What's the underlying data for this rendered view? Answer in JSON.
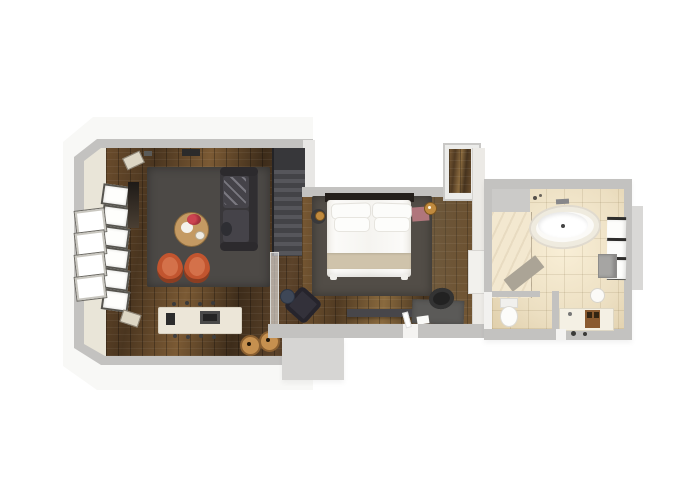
{
  "scene": {
    "type": "floor-plan-3d-render",
    "view": "top-down",
    "description": "3D rendered floor plan of a one-bedroom suite: open living room with staircase, bedroom, corridor closet and bathroom",
    "visible_text": ""
  },
  "colors": {
    "background": "#ffffff",
    "shell_white": "#f8f8f6",
    "wall_gray": "#c3c2c0",
    "inner_face": "#e9e5d8",
    "wood_living": "#4e3a24",
    "wood_bedroom": "#5d452b",
    "rug_living": "#4c4946",
    "rug_bedroom": "#524d47",
    "sofa_dark": "#39373a",
    "sofa_cushion": "#454349",
    "chair_orange": "#c2552f",
    "chair_orange_light": "#d4714a",
    "coffee_table": "#c49a63",
    "media_console": "#ece6d8",
    "stool_wood": "#c6904f",
    "stairs_dark": "#434347",
    "bed_linen": "#f6f5f2",
    "bed_runner": "#cfc3ab",
    "headboard": "#241f1b",
    "bench_mauve": "#b0767c",
    "lamp_brass": "#c08a3e",
    "desk_gray": "#5b5a58",
    "chair_black": "#222222",
    "landing_gray": "#d6d5d3",
    "tile_beige": "#ecdfc2",
    "tile_glow": "#f9efd7",
    "tub_white": "#fbfaf7",
    "shower_mat": "#aba496",
    "cabinet_gray": "#a6a5a3",
    "towel_white": "#fdfdfb",
    "towel_rail": "#2f2e2c",
    "wall_protrusion": "#d9d8d6"
  },
  "rooms": [
    {
      "id": "living-room",
      "furniture": [
        "area rug",
        "sectional sofa with throw",
        "round coffee table with flowers",
        "two orange lounge chairs",
        "media console",
        "two wooden stools",
        "panoramic window wall",
        "wall art",
        "wall speakers"
      ]
    },
    {
      "id": "staircase",
      "furniture": [
        "stairs with glass balustrade"
      ]
    },
    {
      "id": "bedroom",
      "furniture": [
        "double bed with four pillows",
        "bed runner",
        "area rug",
        "round nightstand with brass lamp",
        "mauve bench with brass lamp",
        "dark armchair",
        "round side table",
        "low media bench",
        "desk with chair and papers"
      ]
    },
    {
      "id": "corridor",
      "furniture": [
        "closet nook",
        "wardrobe"
      ]
    },
    {
      "id": "bathroom",
      "furniture": [
        "freestanding oval bathtub",
        "walk-in shower with mat",
        "toilet",
        "vanity with wooden caddy",
        "round sink stool",
        "three towel racks",
        "wall cabinet"
      ]
    }
  ]
}
